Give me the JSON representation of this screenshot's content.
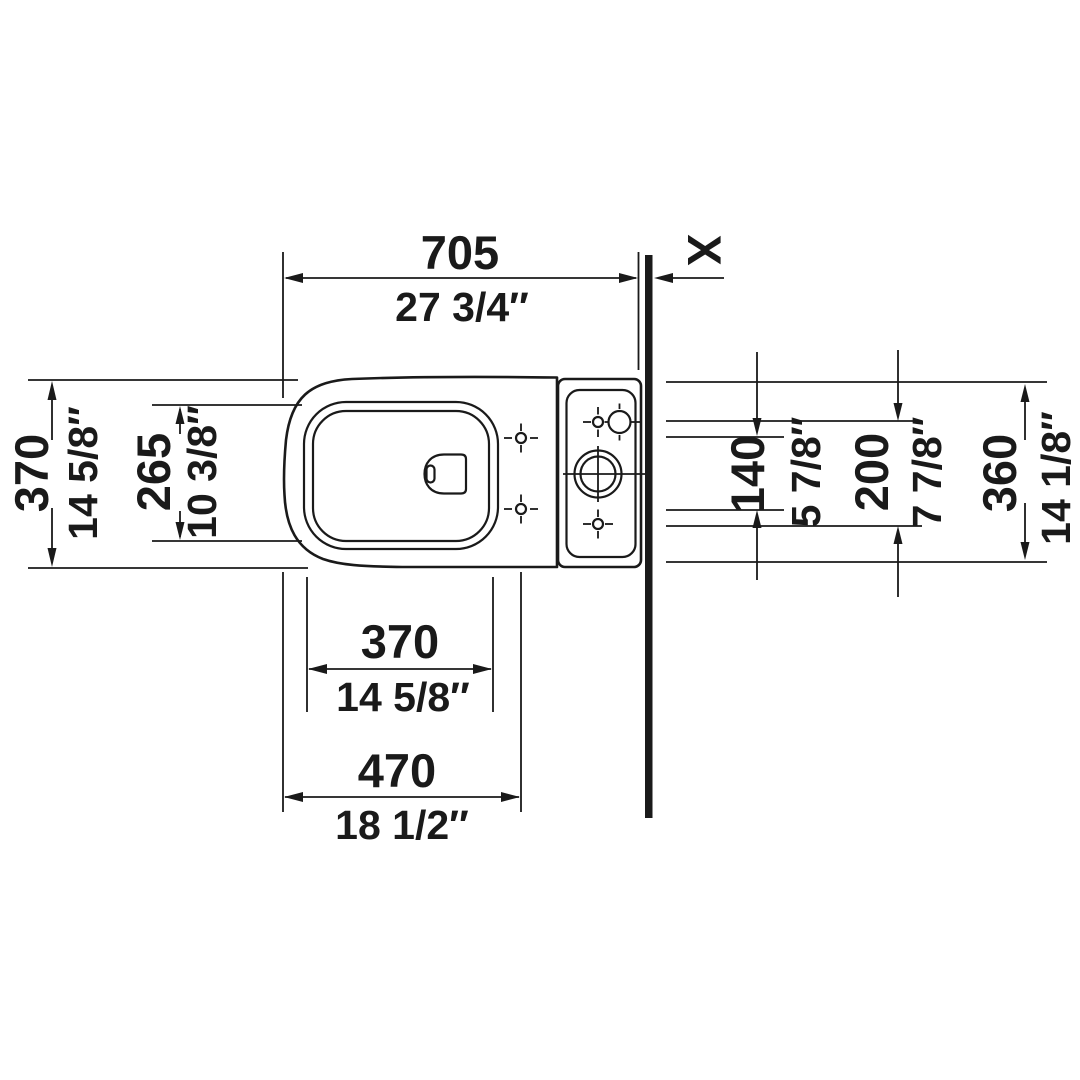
{
  "meta": {
    "drawing_type": "toilet top-view installation dimension drawing",
    "ink_color": "#1a1a1a",
    "background_color": "#ffffff"
  },
  "dims": {
    "depth": {
      "mm": "705",
      "inch": "27 3/4″"
    },
    "wall_gap": {
      "label": "X"
    },
    "overall_width": {
      "mm": "370",
      "inch": "14 5/8″"
    },
    "seat_opening": {
      "mm": "265",
      "inch": "10 3/8″"
    },
    "seat_holes": {
      "mm": "140",
      "inch": "5 7/8″"
    },
    "tank_holes": {
      "mm": "200",
      "inch": "7 7/8″"
    },
    "tank_width": {
      "mm": "360",
      "inch": "14 1/8″"
    },
    "front_width": {
      "mm": "370",
      "inch": "14 5/8″"
    },
    "base_width": {
      "mm": "470",
      "inch": "18 1/2″"
    }
  }
}
